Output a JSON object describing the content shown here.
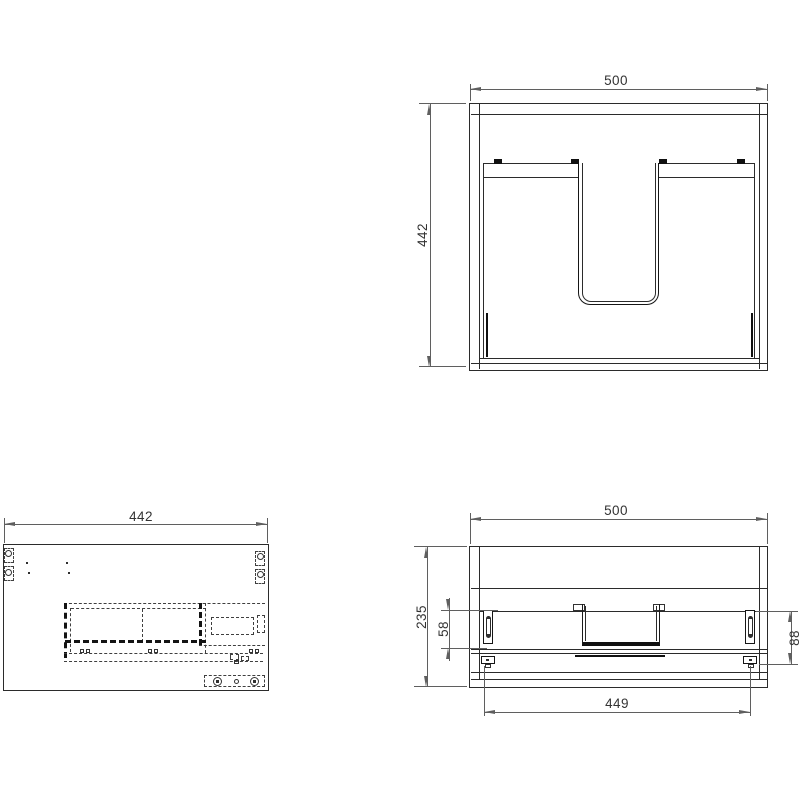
{
  "drawing": {
    "type": "technical-drawing",
    "subject": "wall-hung cabinet with U-shaped plumbing cutout, three orthographic views",
    "colors": {
      "object_line": "#2b2b2b",
      "dim_line": "#5f5f5f",
      "text": "#333333",
      "background": "#ffffff"
    },
    "views": {
      "top": {
        "label": "top-view",
        "dims": {
          "width": "500",
          "depth": "442"
        }
      },
      "side": {
        "label": "side-view",
        "dims": {
          "depth": "442"
        }
      },
      "front": {
        "label": "front-view",
        "dims": {
          "width": "500",
          "height": "235",
          "bracket_left": "58",
          "bracket_right": "88",
          "inner_width": "449"
        }
      }
    }
  }
}
